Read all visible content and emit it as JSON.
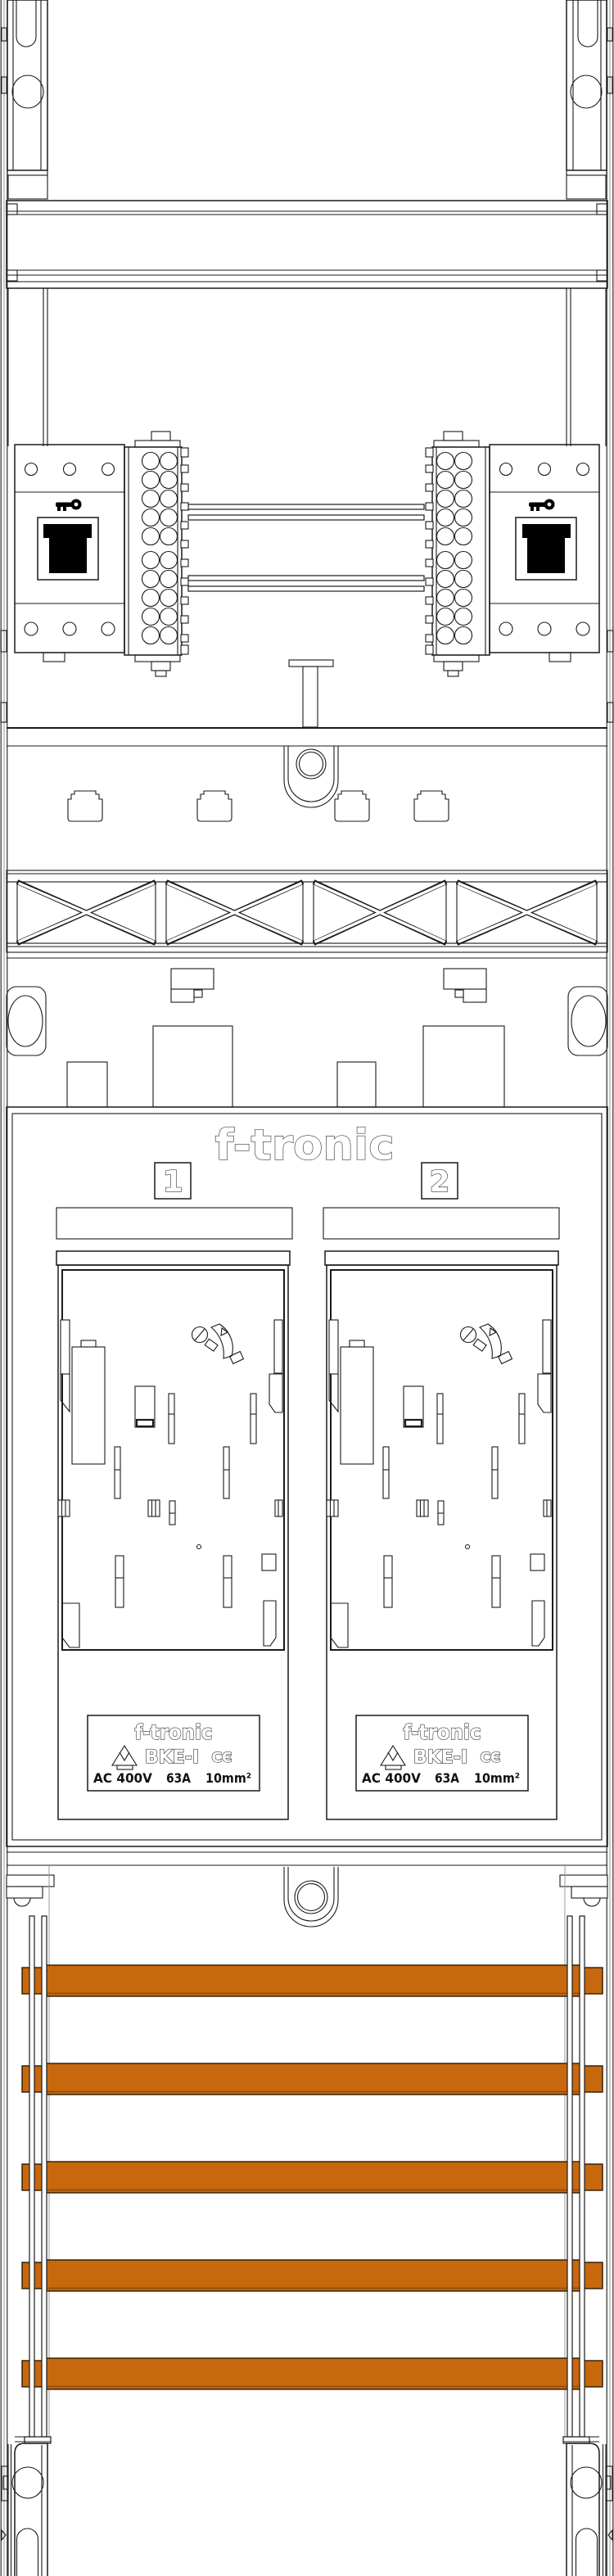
{
  "logo": {
    "text": "f-tronic"
  },
  "fields": [
    {
      "number": "1"
    },
    {
      "number": "2"
    }
  ],
  "rating_label": {
    "brand": "f-tronic",
    "model": "BKE-I",
    "ce_mark": "CЄ",
    "vde_mark": "VDE",
    "voltage": "AC 400V",
    "current": "63A",
    "cross_section": "10mm²"
  },
  "busbars": {
    "count": 5,
    "color": "#c7680e"
  },
  "colors": {
    "line": "#1a1a1a",
    "background": "#ffffff"
  }
}
